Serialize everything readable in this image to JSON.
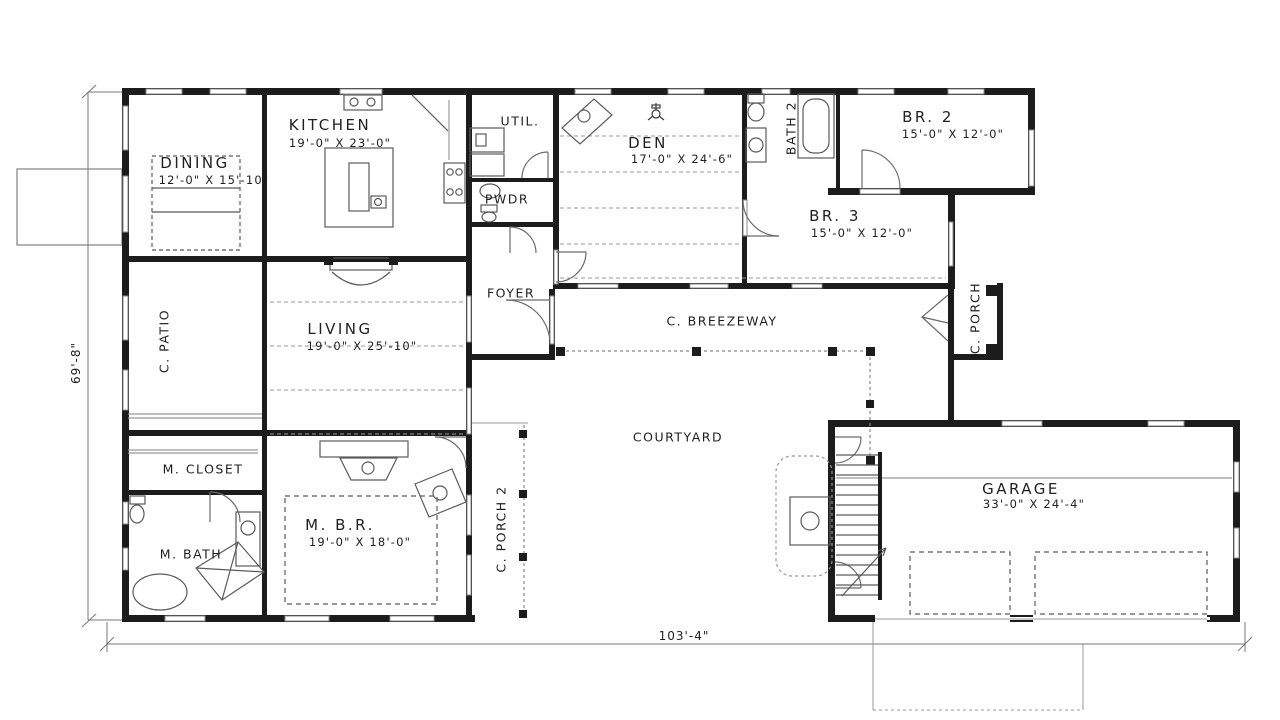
{
  "rooms": {
    "kitchen": {
      "label": "KITCHEN",
      "dims": "19'-0\" X 23'-0\""
    },
    "dining": {
      "label": "DINING",
      "dims": "12'-0\" X 15'-10\""
    },
    "util": {
      "label": "UTIL."
    },
    "pwdr": {
      "label": "PWDR"
    },
    "den": {
      "label": "DEN",
      "dims": "17'-0\" X 24'-6\""
    },
    "bath2": {
      "label": "BATH 2"
    },
    "br2": {
      "label": "BR. 2",
      "dims": "15'-0\" X 12'-0\""
    },
    "br3": {
      "label": "BR. 3",
      "dims": "15'-0\" X 12'-0\""
    },
    "cpatio": {
      "label": "C. PATIO"
    },
    "living": {
      "label": "LIVING",
      "dims": "19'-0\" X 25'-10\""
    },
    "foyer": {
      "label": "FOYER"
    },
    "breezeway": {
      "label": "C. BREEZEWAY"
    },
    "cporch": {
      "label": "C. PORCH"
    },
    "courtyard": {
      "label": "COURTYARD"
    },
    "mcloset": {
      "label": "M. CLOSET"
    },
    "mbath": {
      "label": "M. BATH"
    },
    "mbr": {
      "label": "M. B.R.",
      "dims": "19'-0\" X 18'-0\""
    },
    "cporch2": {
      "label": "C. PORCH 2"
    },
    "garage": {
      "label": "GARAGE",
      "dims": "33'-0\" X 24'-4\""
    }
  },
  "dimensions": {
    "overall_width": "103'-4\"",
    "overall_depth": "69'-8\""
  },
  "colors": {
    "wall": "#1c1c1c",
    "thin_line": "#666666",
    "background": "#ffffff"
  }
}
